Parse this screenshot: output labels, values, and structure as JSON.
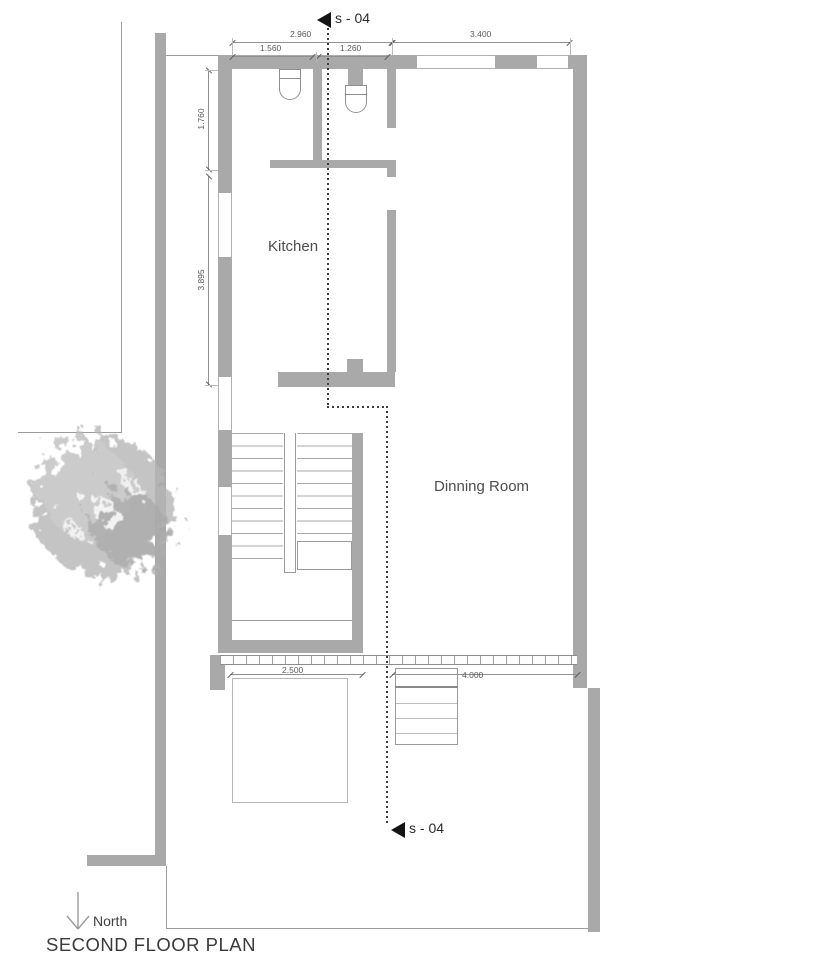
{
  "title": "SECOND FLOOR PLAN",
  "north_label": "North",
  "section_markers": {
    "top": "s - 04",
    "bottom": "s - 04"
  },
  "rooms": {
    "kitchen": "Kitchen",
    "dining": "Dinning Room"
  },
  "dimensions": {
    "top_overall_left": "2.960",
    "top_bath_left": "1.560",
    "top_bath_right": "1.260",
    "top_overall_right": "3.400",
    "left_upper": "1.760",
    "left_lower": "3.895",
    "bottom_terrace": "2.500",
    "bottom_deck": "4.000"
  },
  "colors": {
    "wall": "#a9a9a9",
    "dimension_line": "#909090",
    "section_line": "#3c3c3c",
    "label_text": "#4d4d4d",
    "marker": "#141414",
    "tree": "#b5b5b5"
  }
}
